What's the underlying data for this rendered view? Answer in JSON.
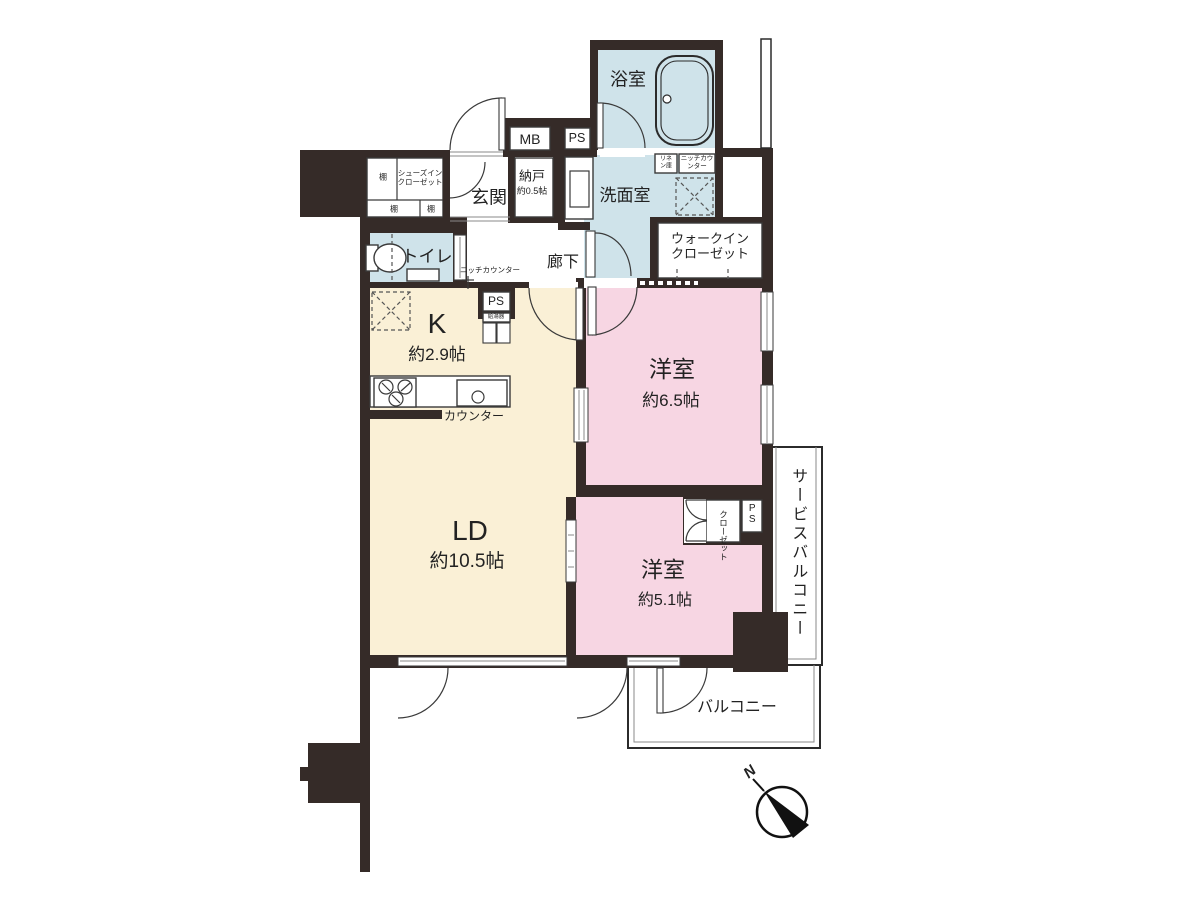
{
  "plan": {
    "rooms": {
      "bath": "浴室",
      "washroom": "洗面室",
      "toilet": "トイレ",
      "entrance": "玄関",
      "storage_name": "納戸",
      "storage_size": "約0.5帖",
      "hallway": "廊下",
      "shoe_closet": "シューズインクローゼット",
      "walkin_closet": "ウォークインクローゼット",
      "kitchen_name": "K",
      "kitchen_size": "約2.9帖",
      "ld_name": "LD",
      "ld_size": "約10.5帖",
      "bedroom1_name": "洋室",
      "bedroom1_size": "約6.5帖",
      "bedroom2_name": "洋室",
      "bedroom2_size": "約5.1帖",
      "closet": "クローゼット",
      "service_balcony": "サービスバルコニー",
      "balcony": "バルコニー"
    },
    "fixtures": {
      "shelf": "棚",
      "mb": "MB",
      "ps": "PS",
      "linen": "リネン庫",
      "niche_counter": "ニッチカウンター",
      "counter": "カウンター",
      "water_heater": "給湯器"
    },
    "compass": {
      "north": "N"
    },
    "colors": {
      "wall": "#352b28",
      "wet_room": "#cfe3ea",
      "living": "#faf0d6",
      "bedroom": "#f7d6e3"
    }
  }
}
